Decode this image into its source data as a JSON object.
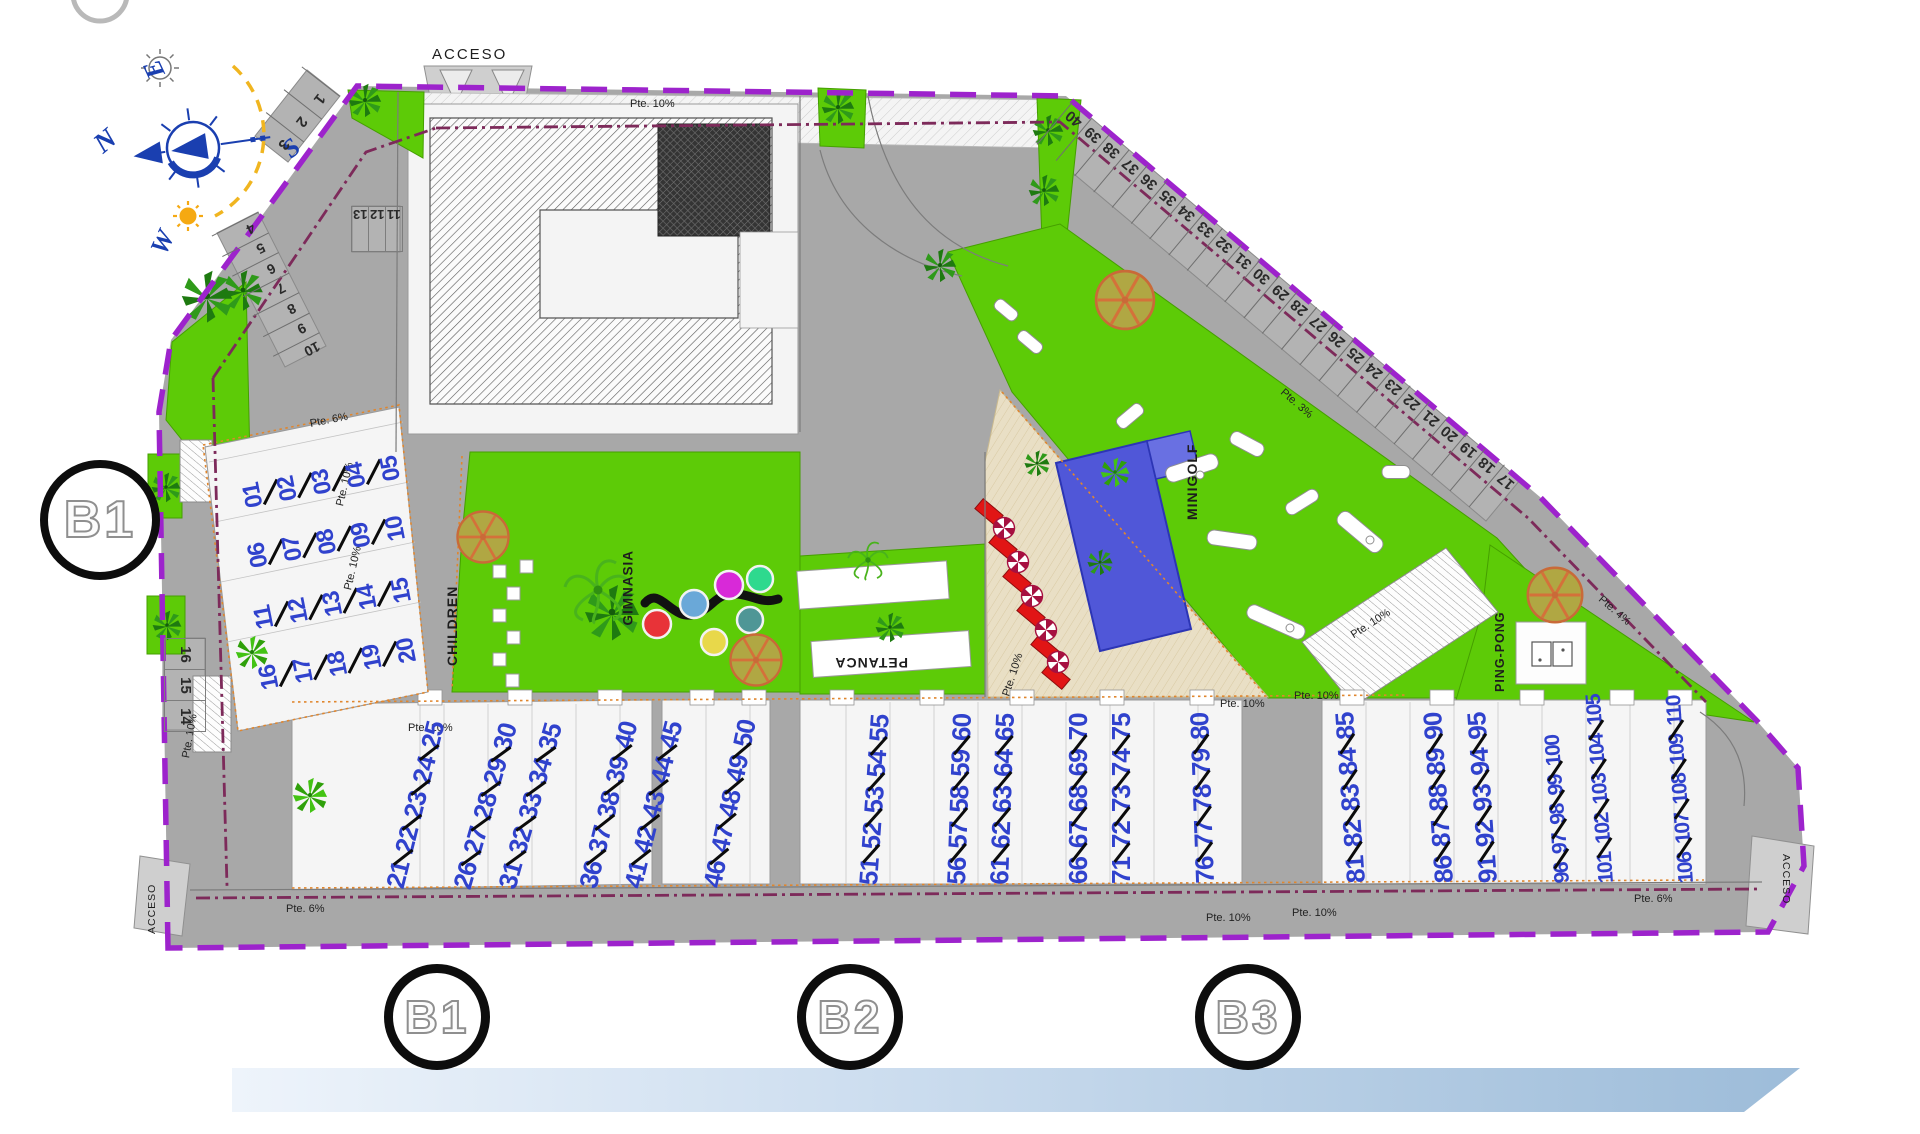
{
  "compass": {
    "north": "N",
    "east": "E",
    "south": "S",
    "west": "W"
  },
  "access": {
    "top": "ACCESO",
    "bottom_left": "ACCESO",
    "bottom_right": "ACCESO"
  },
  "amenities": {
    "children": "CHILDREN",
    "gym": "GIMNASIA",
    "petanque": "PETANCA",
    "minigolf": "MINIGOLF",
    "ping_pong": "PING-PONG"
  },
  "sections": {
    "site_badge": "B1",
    "bottom_badges": [
      "B1",
      "B2",
      "B3"
    ]
  },
  "slope_labels": [
    "Pte. 6%",
    "Pte. 10%",
    "Pte. 10%",
    "Pte. 10%",
    "Pte. 10%",
    "Pte. 10%",
    "Pte. 10%",
    "Pte. 10%",
    "Pte. 3%",
    "Pte. 4%",
    "Pte. 10%",
    "Pte. 10%",
    "Pte. 10%",
    "Pte. 6%",
    "Pte. 6%",
    "Pte. 10%"
  ],
  "parking": {
    "top_left_diag": [
      "1",
      "2",
      "3"
    ],
    "left_edge_diag": [
      "4",
      "5",
      "6",
      "7",
      "8",
      "9",
      "10"
    ],
    "top_box": [
      "13",
      "12",
      "11"
    ],
    "west_column": [
      "16",
      "15",
      "14"
    ],
    "east_edge": [
      "40",
      "39",
      "38",
      "37",
      "36",
      "35",
      "34",
      "33",
      "32",
      "31",
      "30",
      "29",
      "28",
      "27",
      "26",
      "25",
      "24",
      "23",
      "22",
      "21",
      "20",
      "19",
      "18",
      "17"
    ]
  },
  "units": {
    "left_rows": [
      [
        "01",
        "02",
        "03",
        "04",
        "05"
      ],
      [
        "06",
        "07",
        "08",
        "09",
        "10"
      ],
      [
        "11",
        "12",
        "13",
        "14",
        "15"
      ],
      [
        "16",
        "17",
        "18",
        "19",
        "20"
      ]
    ],
    "bottom_columns": [
      [
        "21",
        "22",
        "23",
        "24",
        "25"
      ],
      [
        "26",
        "27",
        "28",
        "29",
        "30"
      ],
      [
        "31",
        "32",
        "33",
        "34",
        "35"
      ],
      [
        "36",
        "37",
        "38",
        "39",
        "40"
      ],
      [
        "41",
        "42",
        "43",
        "44",
        "45"
      ],
      [
        "46",
        "47",
        "48",
        "49",
        "50"
      ],
      [
        "51",
        "52",
        "53",
        "54",
        "55"
      ],
      [
        "56",
        "57",
        "58",
        "59",
        "60"
      ],
      [
        "61",
        "62",
        "63",
        "64",
        "65"
      ],
      [
        "66",
        "67",
        "68",
        "69",
        "70"
      ],
      [
        "71",
        "72",
        "73",
        "74",
        "75"
      ],
      [
        "76",
        "77",
        "78",
        "79",
        "80"
      ],
      [
        "81",
        "82",
        "83",
        "84",
        "85"
      ],
      [
        "86",
        "87",
        "88",
        "89",
        "90"
      ],
      [
        "91",
        "92",
        "93",
        "94",
        "95"
      ],
      [
        "96",
        "97",
        "98",
        "99",
        "100"
      ],
      [
        "101",
        "102",
        "103",
        "104",
        "105"
      ],
      [
        "106",
        "107",
        "108",
        "109",
        "110"
      ]
    ]
  }
}
